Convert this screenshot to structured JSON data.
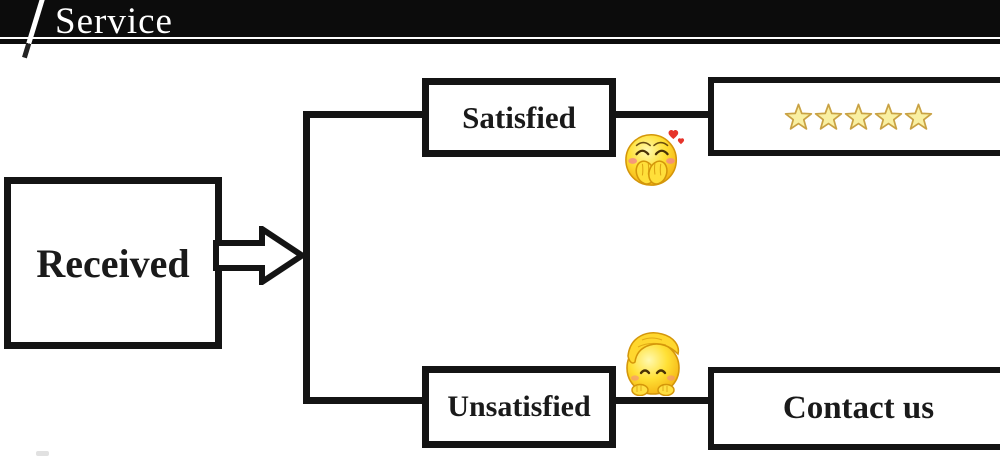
{
  "header": {
    "slash": "/",
    "title": "Service"
  },
  "flow": {
    "received_label": "Received",
    "satisfied_label": "Satisfied",
    "unsatisfied_label": "Unsatisfied",
    "contact_label": "Contact us"
  },
  "rating": {
    "star_count": 5,
    "star_fill": "#f9f0a2",
    "star_stroke": "#c9a244"
  },
  "icons": {
    "arrow": "right-block-arrow",
    "satisfied_emoji": "giggling-face-covering-mouth-with-hearts",
    "unsatisfied_emoji": "embarrassed-face-scratching-head"
  },
  "colors": {
    "page_bg": "#ffffff",
    "header_bg": "#0c0c0c",
    "header_fg": "#ffffff",
    "line": "#141414",
    "box_bg": "#ffffff"
  }
}
